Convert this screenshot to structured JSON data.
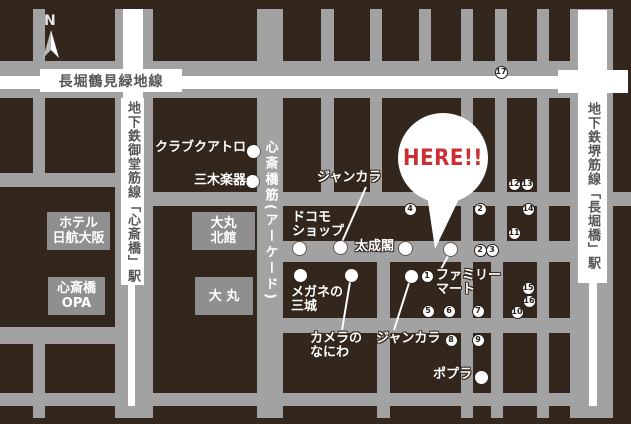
{
  "map": {
    "compass": {
      "label": "N"
    },
    "callout": {
      "label": "HERE!!",
      "color": "#cb2f33"
    },
    "roads": {
      "nagahori": {
        "label": "長堀鶴見緑地線"
      },
      "midosuji": {
        "label": "地下鉄御堂筋線「心斎橋」駅"
      },
      "sakaisuji": {
        "label": "地下鉄堺筋線「長堀橋」駅"
      },
      "arcade": {
        "label": "心斎橋筋(アーケード)"
      }
    },
    "buildings": [
      {
        "id": "hotel-nikko-osaka",
        "lines": [
          "ホテル",
          "日航大阪"
        ],
        "x": 47,
        "y": 212,
        "w": 63,
        "h": 38
      },
      {
        "id": "shinsaibashi-opa",
        "lines": [
          "心斎橋",
          "OPA"
        ],
        "x": 48,
        "y": 277,
        "w": 57,
        "h": 38
      },
      {
        "id": "daimaru-north",
        "lines": [
          "大丸",
          "北館"
        ],
        "x": 192,
        "y": 212,
        "w": 63,
        "h": 38
      },
      {
        "id": "daimaru",
        "lines": [
          "大 丸"
        ],
        "x": 195,
        "y": 277,
        "w": 58,
        "h": 38
      }
    ],
    "pois": [
      {
        "id": "club-quattro",
        "lines": [
          "クラブクアトロ"
        ],
        "label_x": 155,
        "label_y": 141,
        "dot": [
          253,
          151
        ]
      },
      {
        "id": "miki-gakki",
        "lines": [
          "三木楽器"
        ],
        "label_x": 194,
        "label_y": 174,
        "dot": [
          252,
          181
        ]
      },
      {
        "id": "jankara-north",
        "lines": [
          "ジャンカラ"
        ],
        "label_x": 317,
        "label_y": 171,
        "dot": [
          340,
          247
        ],
        "line": [
          366,
          187,
          342,
          242
        ]
      },
      {
        "id": "docomo-shop",
        "lines": [
          "ドコモ",
          "ショップ"
        ],
        "label_x": 292,
        "label_y": 211,
        "dot": [
          299,
          248
        ]
      },
      {
        "id": "taiseikaku",
        "lines": [
          "太成閣"
        ],
        "label_x": 355,
        "label_y": 240,
        "dot": [
          405,
          248
        ]
      },
      {
        "id": "family-mart",
        "lines": [
          "ファミリー",
          "マート"
        ],
        "label_x": 436,
        "label_y": 269,
        "dot": [
          450,
          249
        ],
        "line": [
          448,
          256,
          440,
          271
        ]
      },
      {
        "id": "megane-no-sanjo",
        "lines": [
          "メガネの",
          "三城"
        ],
        "label_x": 291,
        "label_y": 286,
        "dot": [
          300,
          275
        ]
      },
      {
        "id": "camera-no-naniwa",
        "lines": [
          "カメラの",
          "なにわ"
        ],
        "label_x": 310,
        "label_y": 332,
        "dot": [
          351,
          275
        ],
        "line": [
          350,
          282,
          342,
          330
        ]
      },
      {
        "id": "jankara-south",
        "lines": [
          "ジャンカラ"
        ],
        "label_x": 376,
        "label_y": 332,
        "dot": [
          411,
          276
        ],
        "line": [
          409,
          283,
          394,
          330
        ]
      },
      {
        "id": "poplar",
        "lines": [
          "ポプラ"
        ],
        "label_x": 433,
        "label_y": 368,
        "dot": [
          481,
          377
        ]
      }
    ],
    "markers": [
      {
        "n": "1",
        "x": 427,
        "y": 276
      },
      {
        "n": "2",
        "x": 480,
        "y": 209
      },
      {
        "n": "2",
        "x": 480,
        "y": 250
      },
      {
        "n": "3",
        "x": 492,
        "y": 250
      },
      {
        "n": "4",
        "x": 410,
        "y": 209
      },
      {
        "n": "5",
        "x": 428,
        "y": 311
      },
      {
        "n": "6",
        "x": 449,
        "y": 311
      },
      {
        "n": "7",
        "x": 478,
        "y": 311
      },
      {
        "n": "8",
        "x": 451,
        "y": 340
      },
      {
        "n": "9",
        "x": 478,
        "y": 340
      },
      {
        "n": "10",
        "x": 517,
        "y": 312
      },
      {
        "n": "11",
        "x": 514,
        "y": 233
      },
      {
        "n": "12",
        "x": 514,
        "y": 184
      },
      {
        "n": "13",
        "x": 527,
        "y": 184
      },
      {
        "n": "14",
        "x": 528,
        "y": 209
      },
      {
        "n": "15",
        "x": 528,
        "y": 288
      },
      {
        "n": "16",
        "x": 529,
        "y": 301
      },
      {
        "n": "17",
        "x": 501,
        "y": 72
      }
    ],
    "colors": {
      "block": "#33261d",
      "street": "#a2a2a2",
      "building": "#8f8f8f",
      "white": "#ffffff",
      "accent_red": "#cb2f33",
      "road_text": "#575757"
    }
  }
}
